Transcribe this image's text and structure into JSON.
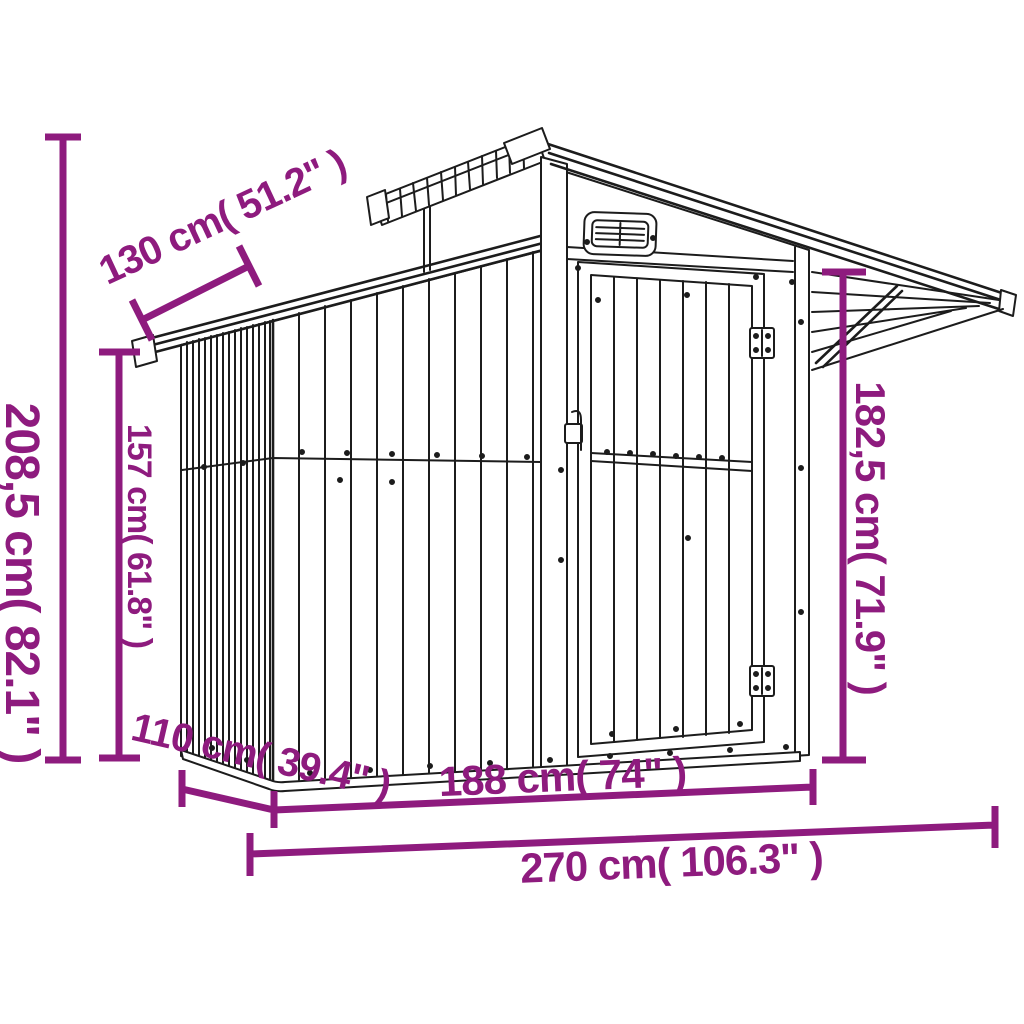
{
  "style": {
    "accent_color": "#8E1B7E",
    "line_color": "#1C1C1C",
    "background": "#FFFFFF"
  },
  "diagram": {
    "kind": "product dimension line drawing",
    "subject": "metal garden shed with overhanging gable roof, raised ventilation roof, air vent grille and hinged door"
  },
  "dimensions": [
    {
      "id": "total_height",
      "label": "208,5 cm( 82.1\" )",
      "cm": "208,5",
      "inches": "82.1",
      "orientation": "vertical"
    },
    {
      "id": "wall_height",
      "label": "157 cm( 61.8\" )",
      "cm": "157",
      "inches": "61.8",
      "orientation": "vertical"
    },
    {
      "id": "roof_depth",
      "label": "130 cm( 51.2\" )",
      "cm": "130",
      "inches": "51.2",
      "orientation": "diagonal"
    },
    {
      "id": "door_side_height",
      "label": "182,5 cm( 71.9\" )",
      "cm": "182,5",
      "inches": "71.9",
      "orientation": "vertical"
    },
    {
      "id": "base_depth",
      "label": "110 cm( 39.4\" )",
      "cm": "110",
      "inches": "39.4",
      "orientation": "diagonal"
    },
    {
      "id": "front_width",
      "label": "188 cm( 74\" )",
      "cm": "188",
      "inches": "74",
      "orientation": "horizontal"
    },
    {
      "id": "total_width",
      "label": "270 cm( 106.3\" )",
      "cm": "270",
      "inches": "106.3",
      "orientation": "horizontal"
    }
  ]
}
